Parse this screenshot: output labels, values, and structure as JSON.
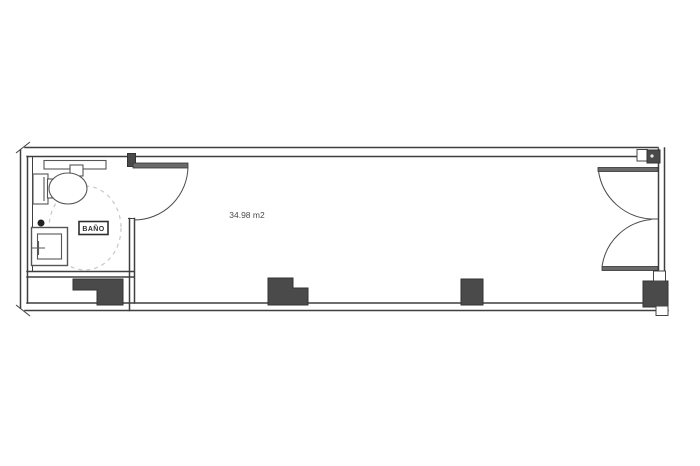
{
  "plan": {
    "bathroom_label": "BAÑO",
    "area_label": "34.98 m2"
  },
  "colors": {
    "background": "#ffffff",
    "line": "#3f3f3f",
    "fixture_line": "#555555",
    "column_fill": "#4a4a4a",
    "door_leaf": "#6a6a6a",
    "dashed_circle": "#c8c8c8",
    "label_text": "#4a4a4a"
  },
  "features": [
    "toilet-icon",
    "sink-icon",
    "counter-icon",
    "accessible-turning-circle-icon",
    "bathroom-door-icon",
    "double-entrance-door-icon",
    "structural-column-icon"
  ]
}
